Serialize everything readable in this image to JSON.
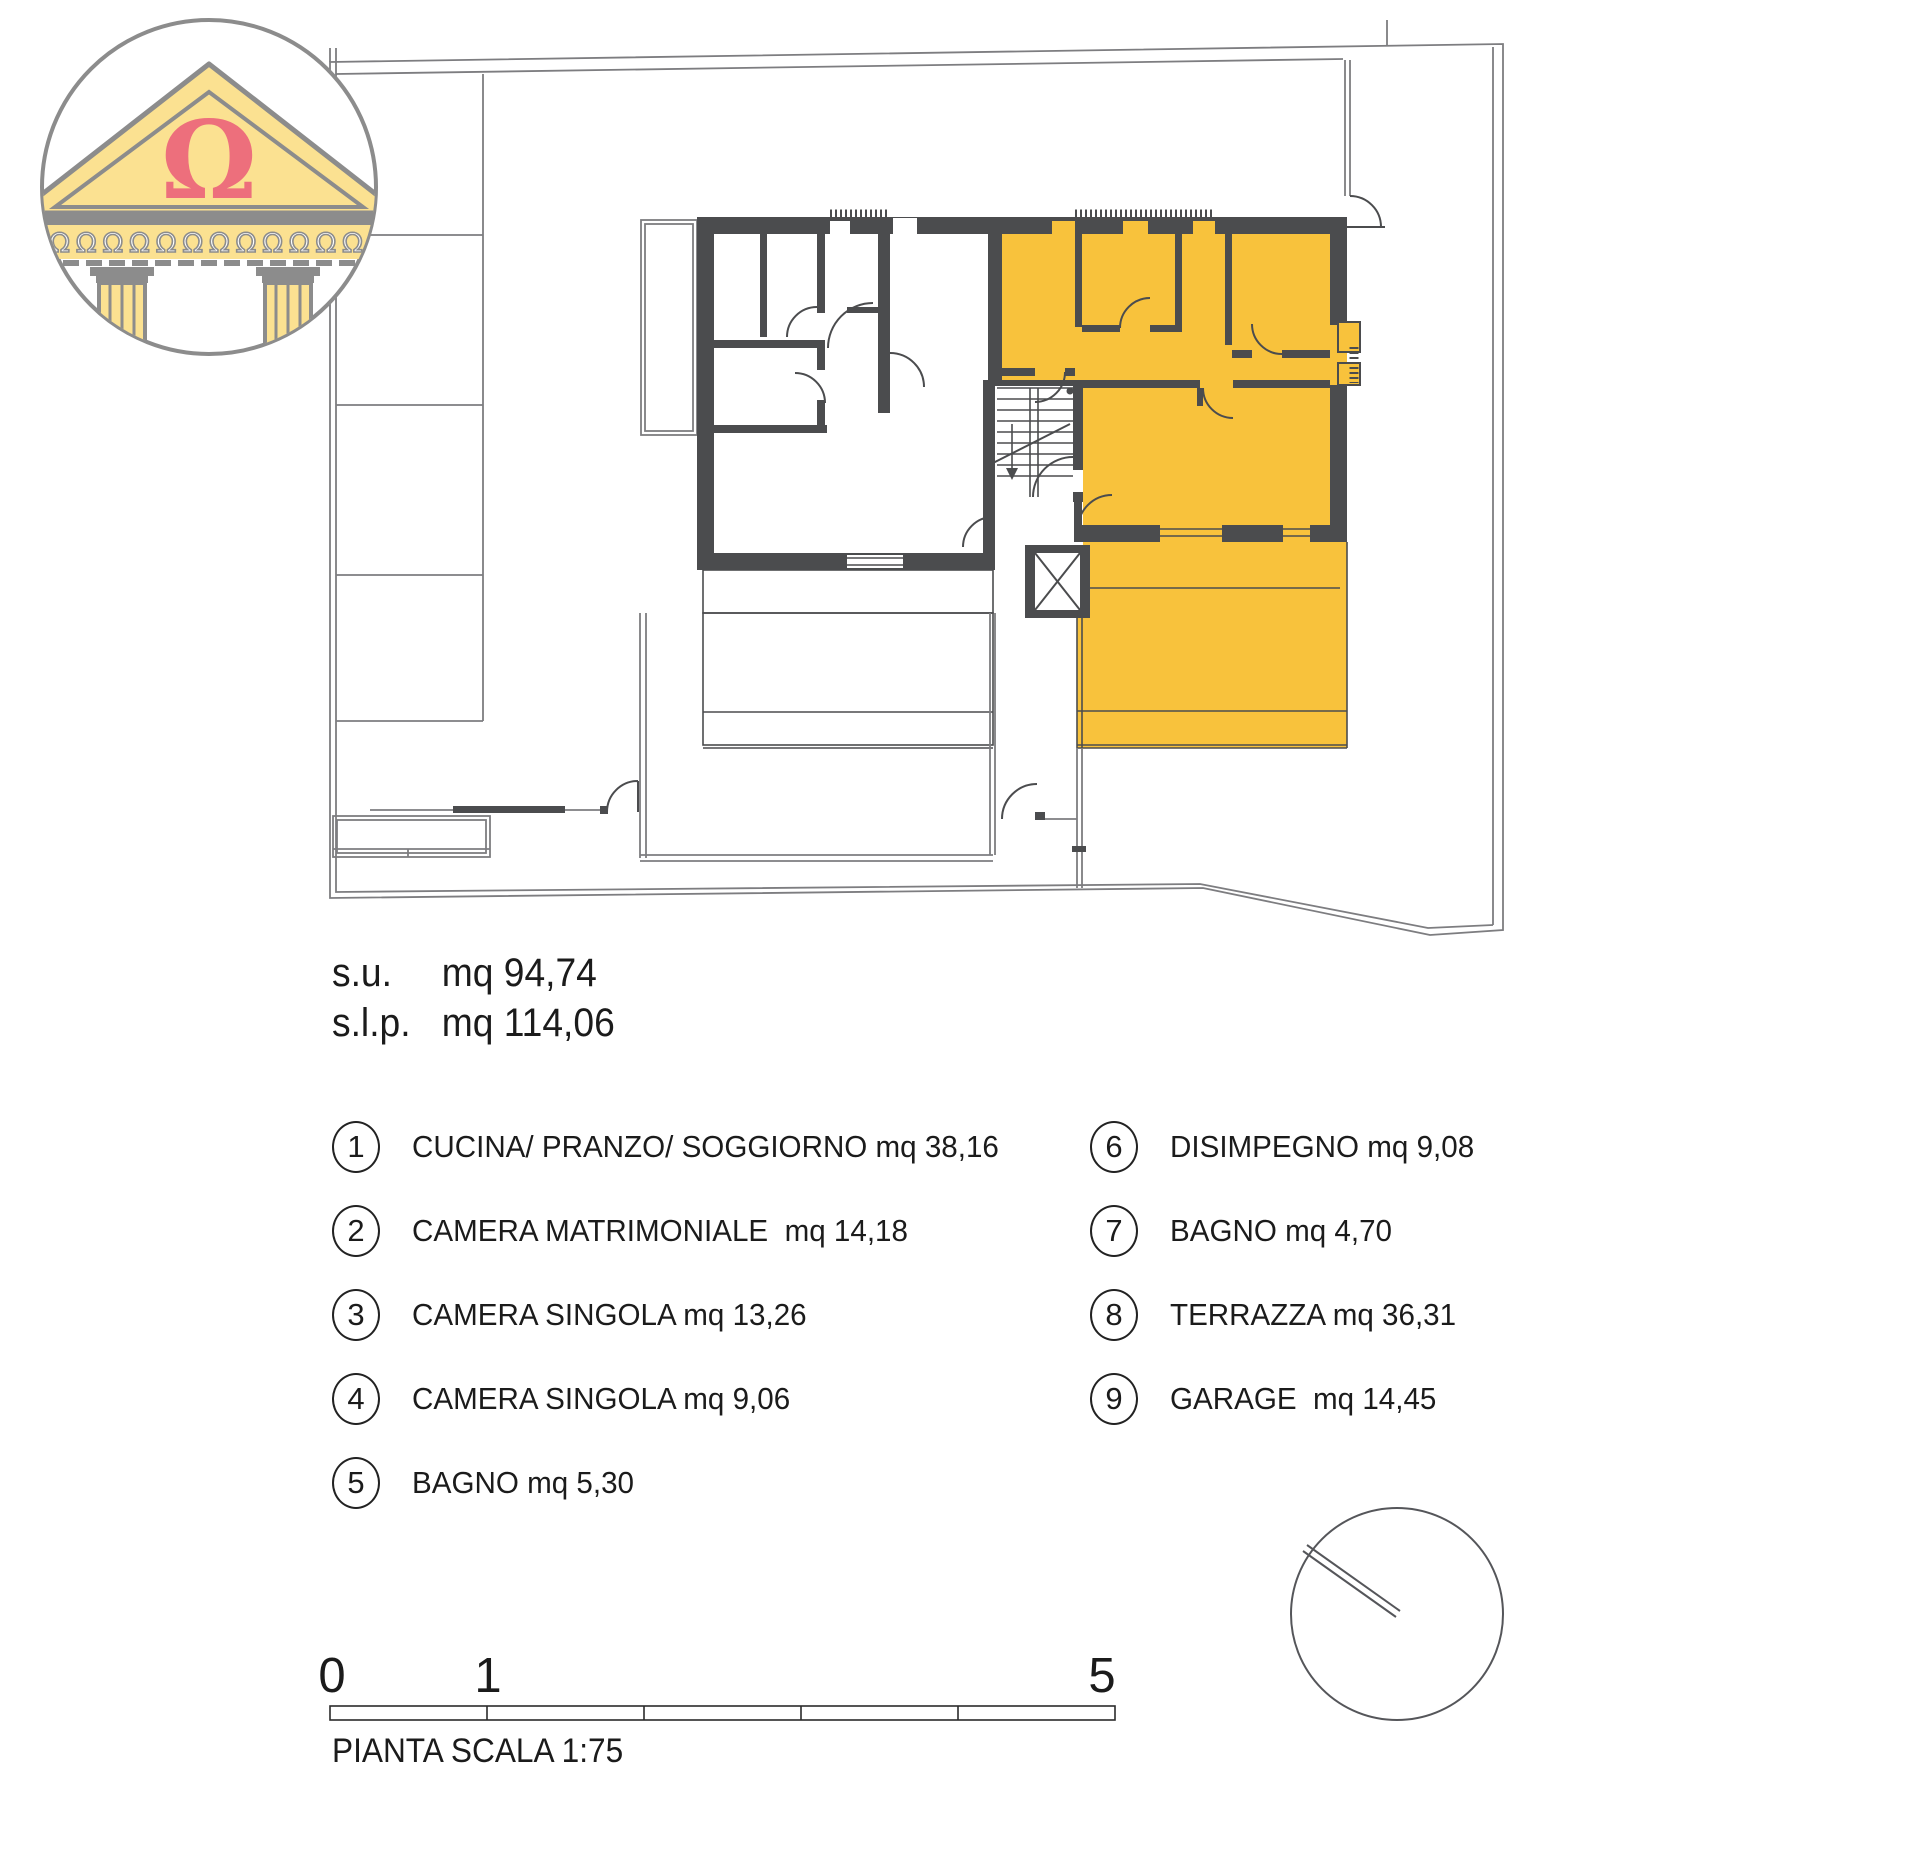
{
  "logo": {
    "symbol": "Ω",
    "frieze": "ΩΩΩΩΩΩΩΩΩΩΩΩ"
  },
  "areas": {
    "su_label": "s.u.",
    "su_value": "mq 94,74",
    "slp_label": "s.l.p.",
    "slp_value": "mq 114,06"
  },
  "legend": {
    "items": [
      {
        "number": "1",
        "label": "CUCINA/ PRANZO/ SOGGIORNO mq 38,16"
      },
      {
        "number": "2",
        "label": "CAMERA MATRIMONIALE  mq 14,18"
      },
      {
        "number": "3",
        "label": "CAMERA SINGOLA mq 13,26"
      },
      {
        "number": "4",
        "label": "CAMERA SINGOLA mq 9,06"
      },
      {
        "number": "5",
        "label": "BAGNO mq 5,30"
      },
      {
        "number": "6",
        "label": "DISIMPEGNO mq 9,08"
      },
      {
        "number": "7",
        "label": "BAGNO mq 4,70"
      },
      {
        "number": "8",
        "label": "TERRAZZA mq 36,31"
      },
      {
        "number": "9",
        "label": "GARAGE  mq 14,45"
      }
    ]
  },
  "scalebar": {
    "tick_start": "0",
    "tick_one": "1",
    "tick_end": "5",
    "caption": "PIANTA SCALA 1:75"
  },
  "colors": {
    "highlight": "#F8C23C",
    "wall": "#4B4C4E",
    "boundary": "#7D7D80",
    "logo_yellow": "#FBE191",
    "logo_gray": "#8C8C8C",
    "logo_red": "#ED6F7C"
  }
}
